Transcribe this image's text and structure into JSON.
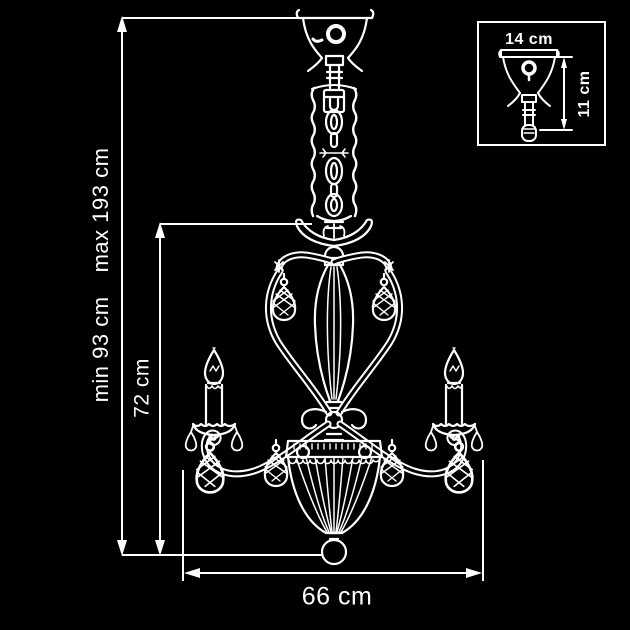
{
  "colors": {
    "background": "#000000",
    "line": "#ffffff",
    "text": "#ffffff"
  },
  "figure": {
    "main": "chandelier-front-view-line-drawing",
    "inset": "ceiling-canopy-detail-drawing"
  },
  "labels": {
    "height_min": "min 93 cm",
    "height_max": "max 193 cm",
    "body_height": "72 cm",
    "width": "66 cm"
  },
  "inset": {
    "canopy_width": "14 cm",
    "canopy_height": "11 cm"
  }
}
